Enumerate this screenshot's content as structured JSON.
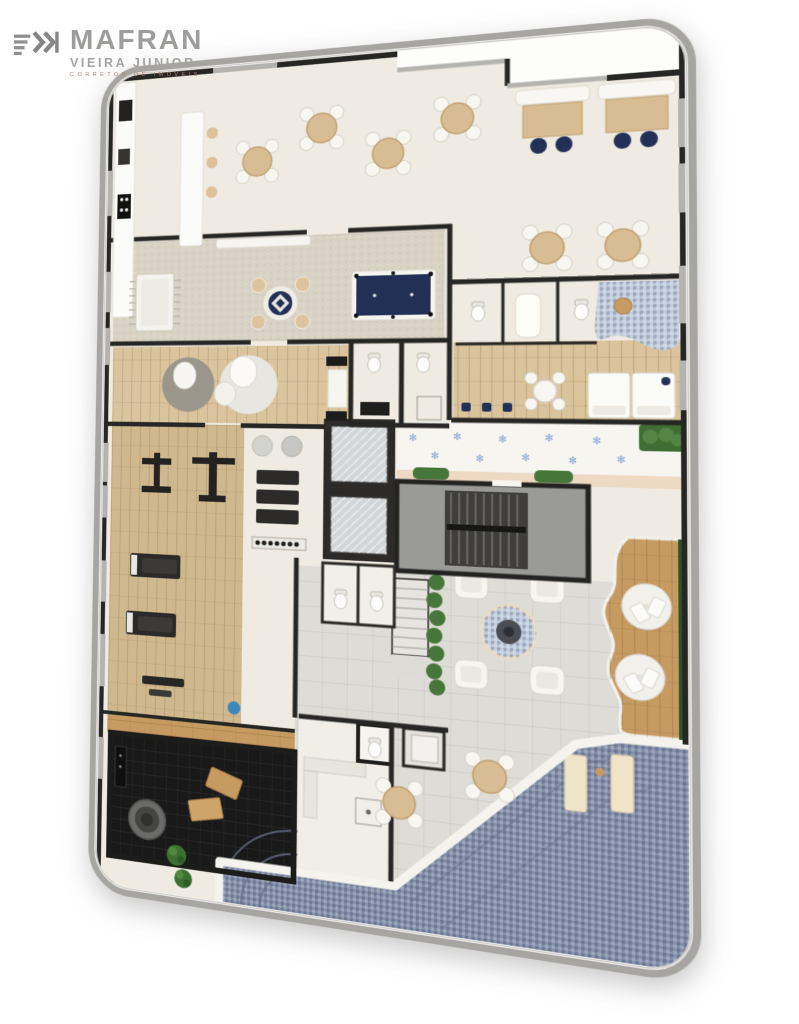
{
  "logo": {
    "title": "MAFRAN",
    "subtitle": "VIEIRA JUNIOR",
    "tagline": "CORRETOR DE IMÓVEIS"
  },
  "decor": {
    "flower_glyph": "✻"
  },
  "colors": {
    "page_bg": "#ffffff",
    "frame": "#a6a5a1",
    "floor_cream": "#efebe2",
    "floor_white": "#f7f5f0",
    "wood_light": "#dac49e",
    "wood_gym": "#d0b88e",
    "wood_deck": "#c69b62",
    "carpet": "#d8d3c5",
    "concrete": "#dedcd6",
    "pool": "#8691ab",
    "splash": "#c3cedf",
    "navy": "#223055",
    "plant": "#47763a",
    "wall": "#262624",
    "window": "#b4b3af",
    "sauna_floor": "#191919",
    "stair_floor": "#9a9a97",
    "marble": "#d3d6d9",
    "peach": "#eed9c2",
    "white_furniture": "#f7f6f1",
    "table_wood": "#d8bc93",
    "pool_rim": "#f4f3ee",
    "rug_gray": "#9a968c",
    "rug_white": "#e8e6e0",
    "lounger_cream": "#efe3c8",
    "flower_blue": "#86a3d2",
    "water_cooler": "#3e87bb"
  }
}
